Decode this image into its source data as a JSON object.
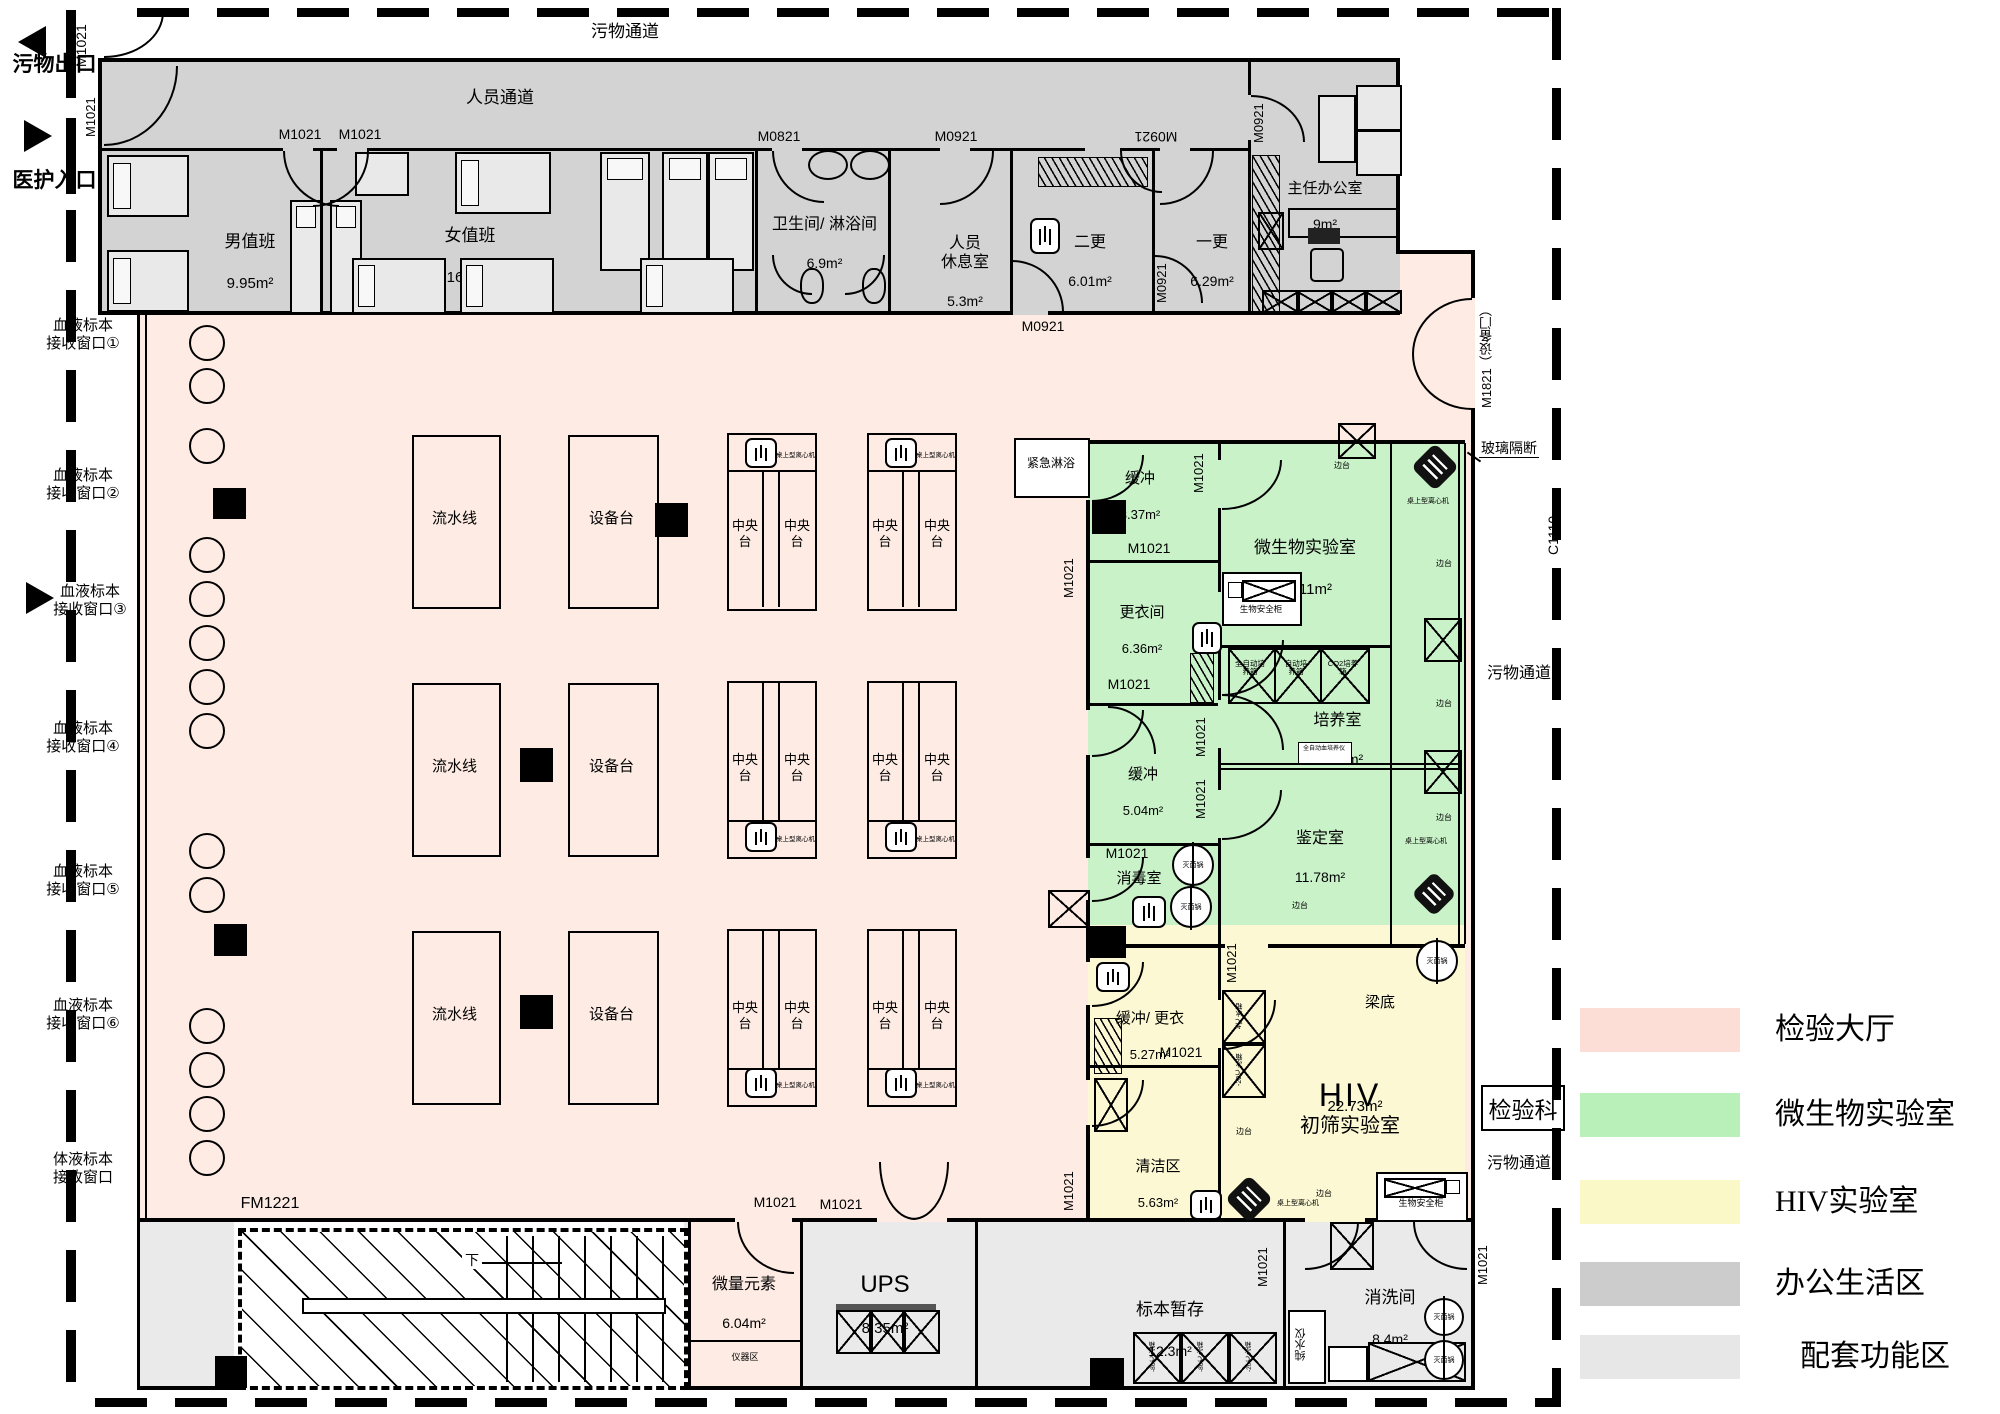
{
  "plan": {
    "department_box": "检验科",
    "corridor_top": "污物通道",
    "corridor_personnel": "人员通道",
    "corridor_right_upper": "污物通道",
    "corridor_right_lower": "污物通道",
    "glass_partition": "玻璃隔断",
    "beam_note": "梁底",
    "waste_exit": "污物出口",
    "staff_entrance": "医护入口",
    "emergency_shower": "紧急淋浴",
    "stair_down": "下"
  },
  "reception": [
    "血液标本\n接收窗口①",
    "血液标本\n接收窗口②",
    "血液标本\n接收窗口③",
    "血液标本\n接收窗口④",
    "血液标本\n接收窗口⑤",
    "血液标本\n接收窗口⑥",
    "体液标本\n接收窗口"
  ],
  "doors": {
    "m1021": "M1021",
    "m0821": "M0821",
    "m0921": "M0921",
    "m1821": "M1821（设备门）",
    "fm1221": "FM1221",
    "c1110": "C1110"
  },
  "office": {
    "male_duty": {
      "name": "男值班",
      "area": "9.95m²"
    },
    "female_duty": {
      "name": "女值班",
      "area": "16.4m²"
    },
    "bathroom": {
      "name": "卫生间/ 淋浴间",
      "area": "6.9m²"
    },
    "lounge": {
      "name": "人员\n休息室",
      "area": "5.3m²"
    },
    "change2": {
      "name": "二更",
      "area": "6.01m²"
    },
    "change1": {
      "name": "一更",
      "area": "6.29m²"
    },
    "director": {
      "name": "主任办公室",
      "area": "9m²"
    }
  },
  "hall": {
    "line": "流水线",
    "equip": "设备台",
    "central": "中央台",
    "centrifuge": "桌上型离心机"
  },
  "micro": {
    "buffer1": {
      "name": "缓冲",
      "area": "3.37m²"
    },
    "lab": {
      "name": "微生物实验室",
      "area": "15.11m²"
    },
    "change": {
      "name": "更衣间",
      "area": "6.36m²"
    },
    "culture": {
      "name": "培养室",
      "area": "10.14m²"
    },
    "buffer2": {
      "name": "缓冲",
      "area": "5.04m²"
    },
    "identify": {
      "name": "鉴定室",
      "area": "11.78m²"
    },
    "disinfect": {
      "name": "消毒室"
    }
  },
  "hiv": {
    "buffer": {
      "name": "缓冲/ 更衣",
      "area": "5.27m²"
    },
    "clean": {
      "name": "清洁区",
      "area": "5.63m²"
    },
    "lab_en": "HIV",
    "lab_cn": "初筛实验室",
    "lab_area": "22.73m²"
  },
  "support": {
    "trace": {
      "name": "微量元素",
      "area": "6.04m²"
    },
    "instrument_strip": "仪器区",
    "ups": {
      "name": "UPS",
      "area": "8.35m²"
    },
    "storage": {
      "name": "标本暂存",
      "area": "12.3m²"
    },
    "wash": {
      "name": "消洗间",
      "area": "8.4m²"
    }
  },
  "equipment": {
    "bio_cabinet": "生物安全柜",
    "sterilizer": "灭菌锅",
    "water_purifier": "纯水仪",
    "side_bench": "边台",
    "incubator_full": "全自动培\n养箱",
    "incubator_auto": "自动培\n养箱",
    "incubator_co2": "CO2培养\n箱",
    "blood_culture": "全自动血培养仪",
    "fridge": "冰箱",
    "fridge_4": "4℃冰箱",
    "fridge_m20": "-20℃冰箱",
    "fridge_m86": "-86℃冰箱"
  },
  "legend": [
    {
      "label": "检验大厅",
      "color": "#fcded6"
    },
    {
      "label": "微生物实验室",
      "color": "#b9f0b9"
    },
    {
      "label": "HIV实验室",
      "color": "#fbf8c8"
    },
    {
      "label": "办公生活区",
      "color": "#cccccc"
    },
    {
      "label": "配套功能区",
      "color": "#e7e7e7"
    }
  ],
  "zone_colors": {
    "hall": "#fdebe4",
    "micro": "#c9f2c9",
    "hiv": "#fbf8d3",
    "office": "#d3d3d3",
    "support": "#eaeaea"
  }
}
